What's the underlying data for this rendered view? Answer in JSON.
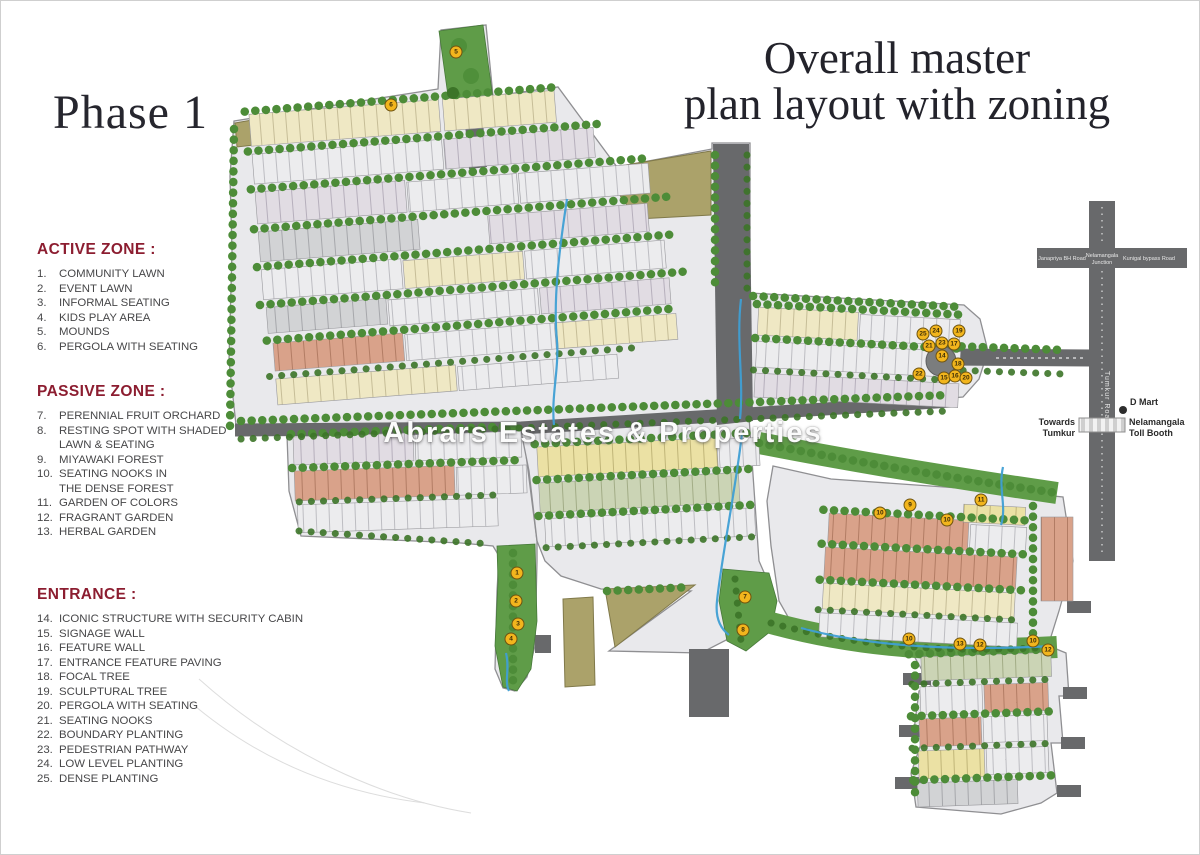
{
  "page": {
    "phase_label": "Phase 1",
    "title_line1": "Overall master",
    "title_line2": "plan layout with zoning",
    "watermark": "Abrars Estates & Properties"
  },
  "legend": {
    "sections": [
      {
        "heading": "ACTIVE ZONE :",
        "items": [
          {
            "n": "1.",
            "t": "COMMUNITY LAWN"
          },
          {
            "n": "2.",
            "t": "EVENT LAWN"
          },
          {
            "n": "3.",
            "t": "INFORMAL SEATING"
          },
          {
            "n": "4.",
            "t": "KIDS PLAY AREA"
          },
          {
            "n": "5.",
            "t": "MOUNDS"
          },
          {
            "n": "6.",
            "t": "PERGOLA WITH SEATING"
          }
        ]
      },
      {
        "heading": "PASSIVE ZONE :",
        "items": [
          {
            "n": "7.",
            "t": "PERENNIAL FRUIT ORCHARD"
          },
          {
            "n": "8.",
            "t": "RESTING SPOT WITH SHADED\nLAWN & SEATING"
          },
          {
            "n": "9.",
            "t": "MIYAWAKI FOREST"
          },
          {
            "n": "10.",
            "t": "SEATING NOOKS IN\nTHE DENSE FOREST"
          },
          {
            "n": "11.",
            "t": "GARDEN OF COLORS"
          },
          {
            "n": "12.",
            "t": "FRAGRANT GARDEN"
          },
          {
            "n": "13.",
            "t": "HERBAL GARDEN"
          }
        ]
      },
      {
        "heading": "ENTRANCE :",
        "items": [
          {
            "n": "14.",
            "t": "ICONIC STRUCTURE WITH SECURITY CABIN"
          },
          {
            "n": "15.",
            "t": "SIGNAGE WALL"
          },
          {
            "n": "16.",
            "t": "FEATURE WALL"
          },
          {
            "n": "17.",
            "t": "ENTRANCE FEATURE PAVING"
          },
          {
            "n": "18.",
            "t": "FOCAL TREE"
          },
          {
            "n": "19.",
            "t": "SCULPTURAL TREE"
          },
          {
            "n": "20.",
            "t": "PERGOLA WITH SEATING"
          },
          {
            "n": "21.",
            "t": "SEATING NOOKS"
          },
          {
            "n": "22.",
            "t": "BOUNDARY PLANTING"
          },
          {
            "n": "23.",
            "t": "PEDESTRIAN PATHWAY"
          },
          {
            "n": "24.",
            "t": "LOW LEVEL PLANTING"
          },
          {
            "n": "25.",
            "t": "DENSE PLANTING"
          }
        ]
      }
    ]
  },
  "map": {
    "markers": [
      {
        "n": "5",
        "x": 455,
        "y": 51
      },
      {
        "n": "6",
        "x": 390,
        "y": 104
      },
      {
        "n": "1",
        "x": 516,
        "y": 572
      },
      {
        "n": "2",
        "x": 515,
        "y": 600
      },
      {
        "n": "3",
        "x": 517,
        "y": 623
      },
      {
        "n": "4",
        "x": 510,
        "y": 638
      },
      {
        "n": "7",
        "x": 744,
        "y": 596
      },
      {
        "n": "8",
        "x": 742,
        "y": 629
      },
      {
        "n": "10",
        "x": 879,
        "y": 512
      },
      {
        "n": "9",
        "x": 909,
        "y": 504
      },
      {
        "n": "10",
        "x": 946,
        "y": 519
      },
      {
        "n": "11",
        "x": 980,
        "y": 499
      },
      {
        "n": "10",
        "x": 908,
        "y": 638
      },
      {
        "n": "13",
        "x": 959,
        "y": 643
      },
      {
        "n": "12",
        "x": 979,
        "y": 644
      },
      {
        "n": "10",
        "x": 1032,
        "y": 640
      },
      {
        "n": "12",
        "x": 1047,
        "y": 649
      },
      {
        "n": "25",
        "x": 922,
        "y": 333
      },
      {
        "n": "24",
        "x": 935,
        "y": 330
      },
      {
        "n": "19",
        "x": 958,
        "y": 330
      },
      {
        "n": "21",
        "x": 928,
        "y": 345
      },
      {
        "n": "23",
        "x": 941,
        "y": 342
      },
      {
        "n": "17",
        "x": 953,
        "y": 343
      },
      {
        "n": "14",
        "x": 941,
        "y": 355
      },
      {
        "n": "18",
        "x": 957,
        "y": 363
      },
      {
        "n": "22",
        "x": 918,
        "y": 373
      },
      {
        "n": "15",
        "x": 943,
        "y": 377
      },
      {
        "n": "16",
        "x": 954,
        "y": 375
      },
      {
        "n": "20",
        "x": 965,
        "y": 377
      }
    ]
  },
  "roadmap": {
    "junction_left": "Janapriya BH Road",
    "junction_center_l1": "Nelamangala",
    "junction_center_l2": "Junction",
    "junction_right": "Kunigal bypass Road",
    "vertical_road": "Tumkur Road",
    "dmart": "D Mart",
    "towards_l1": "Towards",
    "towards_l2": "Tumkur",
    "tollbooth_l1": "Nelamangala",
    "tollbooth_l2": "Toll Booth"
  },
  "colors": {
    "accent_maroon": "#8c1d30",
    "marker_yellow": "#f2b51d",
    "road_gray": "#68696b",
    "tree_green": "#4d8c38",
    "stream_blue": "#3f9fd4",
    "khaki": "#aba26a",
    "salmon_plot": "#d9a28a",
    "cream_plot": "#efe8c4"
  }
}
